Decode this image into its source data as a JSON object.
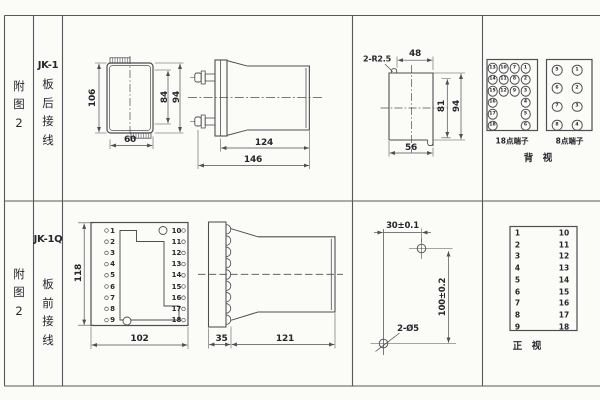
{
  "colors": {
    "background": "#fbfbf8",
    "line": "#4e4e53",
    "text": "#26262c"
  },
  "top": {
    "fig": [
      "附",
      "图",
      "2"
    ],
    "model": "JK-1",
    "wiring": [
      "板",
      "后",
      "接",
      "线"
    ],
    "front_view": {
      "h106": "106",
      "h84": "84",
      "h94": "94",
      "w60": "60"
    },
    "side_view": {
      "d124": "124",
      "d146": "146"
    },
    "cutout": {
      "radius": "2-R2.5",
      "w48": "48",
      "h81": "81",
      "h94": "94",
      "w56": "56"
    },
    "t18": {
      "label": "18点端子",
      "col1": [
        "13",
        "14",
        "15",
        "16",
        "17",
        "18"
      ],
      "col2": [
        "10",
        "11",
        "12"
      ],
      "col3": [
        "7",
        "8",
        "9"
      ],
      "col4": [
        "1",
        "2",
        "3",
        "4",
        "5",
        "6"
      ]
    },
    "t8": {
      "label": "8点端子",
      "col1": [
        "5",
        "6",
        "7",
        "8"
      ],
      "col2": [
        "1",
        "2",
        "3",
        "4"
      ]
    },
    "view_label": "背　视"
  },
  "bottom": {
    "fig": [
      "附",
      "图",
      "2"
    ],
    "model": "JK-1Q",
    "wiring": [
      "板",
      "前",
      "接",
      "线"
    ],
    "front_view": {
      "h118": "118",
      "w102": "102",
      "left": [
        "1",
        "2",
        "3",
        "4",
        "5",
        "6",
        "7",
        "8",
        "9"
      ],
      "right": [
        "10",
        "11",
        "12",
        "13",
        "14",
        "15",
        "16",
        "17",
        "18"
      ]
    },
    "side_view": {
      "d35": "35",
      "d121": "121"
    },
    "drilling": {
      "dh": "30±0.1",
      "dv": "100±0.2",
      "holes": "2-Ø5"
    },
    "table": {
      "left": [
        "1",
        "2",
        "3",
        "4",
        "5",
        "6",
        "7",
        "8",
        "9"
      ],
      "right": [
        "10",
        "11",
        "12",
        "13",
        "14",
        "15",
        "16",
        "17",
        "18"
      ],
      "view_label": "正　视"
    }
  }
}
